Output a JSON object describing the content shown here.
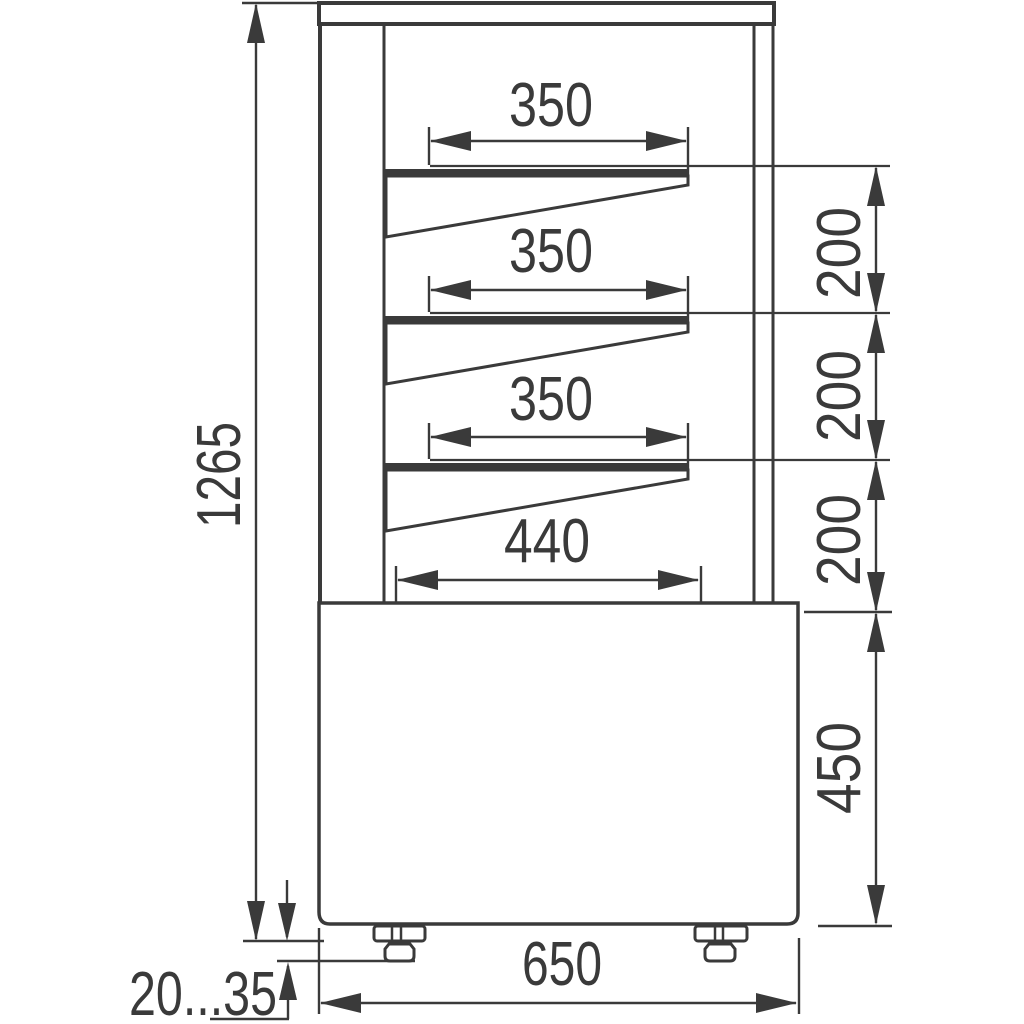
{
  "drawing": {
    "dimensions": {
      "overall_height": "1265",
      "shelf_widths": [
        "350",
        "350",
        "350"
      ],
      "shelf_spacings": [
        "200",
        "200",
        "200"
      ],
      "deck_depth": "440",
      "base_height": "450",
      "base_width": "650",
      "foot_height_range": "20...35"
    },
    "colors": {
      "line": "#3a3a3a",
      "background": "#ffffff"
    }
  }
}
